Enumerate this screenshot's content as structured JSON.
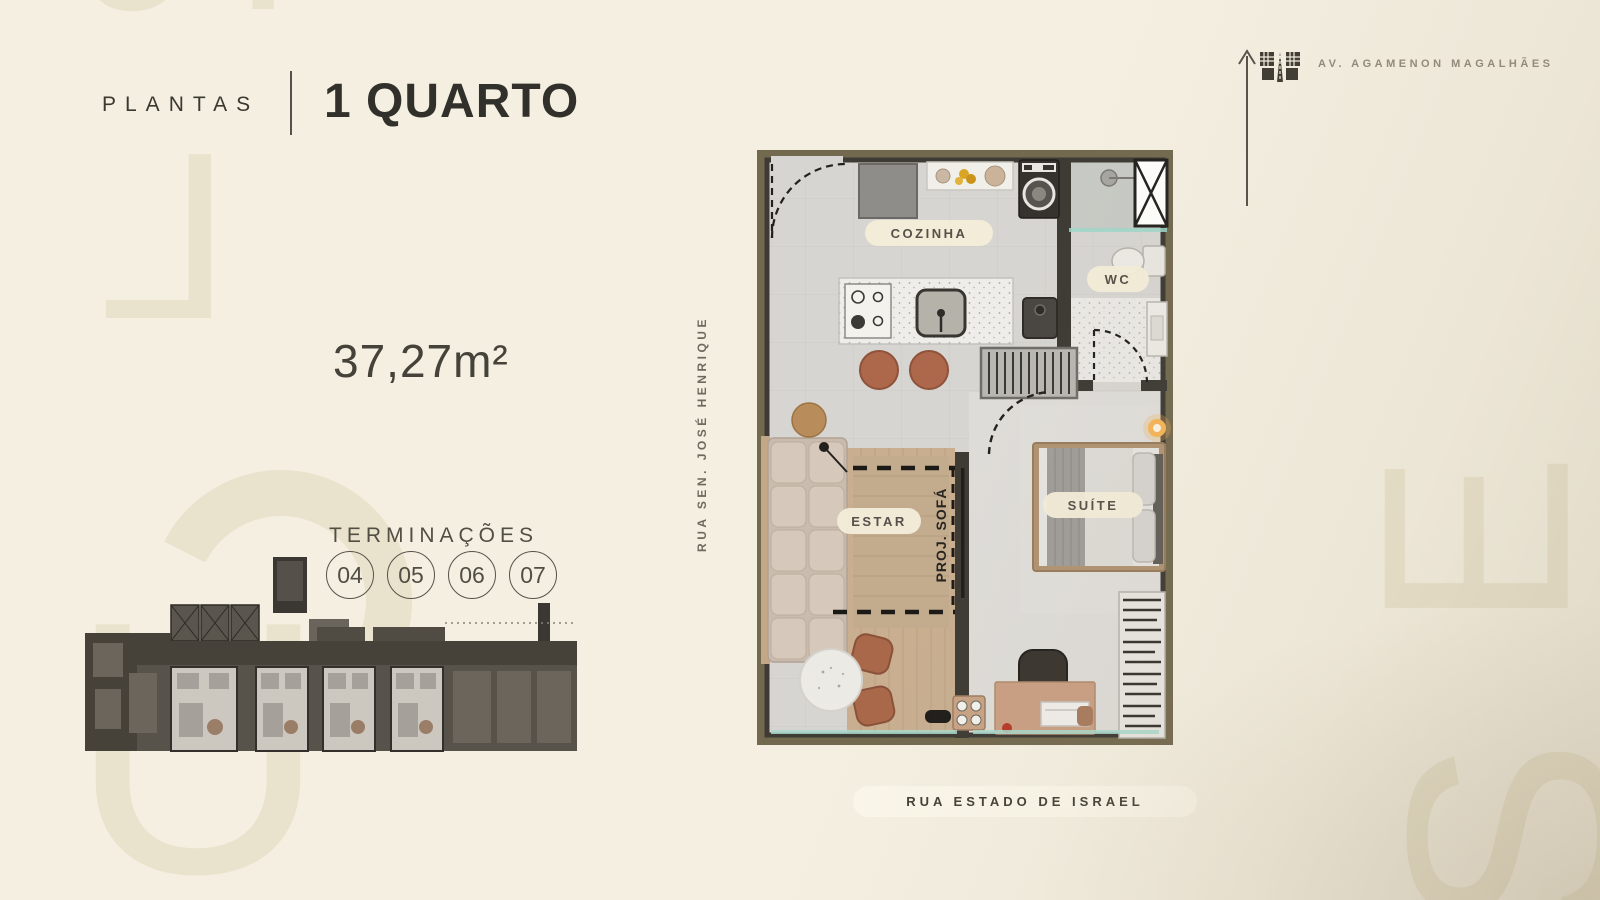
{
  "header": {
    "eyebrow": "PLANTAS",
    "title": "1 QUARTO"
  },
  "area_label": "37,27m²",
  "terminations": {
    "label": "TERMINAÇÕES",
    "units": [
      "04",
      "05",
      "06",
      "07"
    ]
  },
  "floorplan": {
    "rooms": {
      "kitchen": "COZINHA",
      "bathroom": "WC",
      "living": "ESTAR",
      "bedroom": "SUÍTE"
    },
    "annotation_sofa": "PROJ. SOFÁ"
  },
  "streets": {
    "left_vertical": "RUA SEN. JOSÉ HENRIQUE",
    "bottom": "RUA ESTADO DE ISRAEL",
    "avenue": "AV. AGAMENON MAGALHÃES"
  },
  "watermark": {
    "number": "07",
    "letter_l": "L",
    "letter_u": "U",
    "letter_e": "E",
    "letter_s": "S"
  },
  "icons": {
    "north_arrow": "up-arrow",
    "avenue_icon": "road-between-buildings"
  },
  "colors": {
    "background": "#f4efe1",
    "watermark": "#e9e2cc",
    "text_dark": "#31302a",
    "pill_bg": "#f2ecd9",
    "plan_frame": "#73694f",
    "wall": "#3e3b35",
    "floor": "#d7d5d1",
    "wood": "#c9ae90",
    "stool": "#ad684c",
    "glass": "#9fd6c9",
    "lamp_glow": "#f5b558"
  }
}
